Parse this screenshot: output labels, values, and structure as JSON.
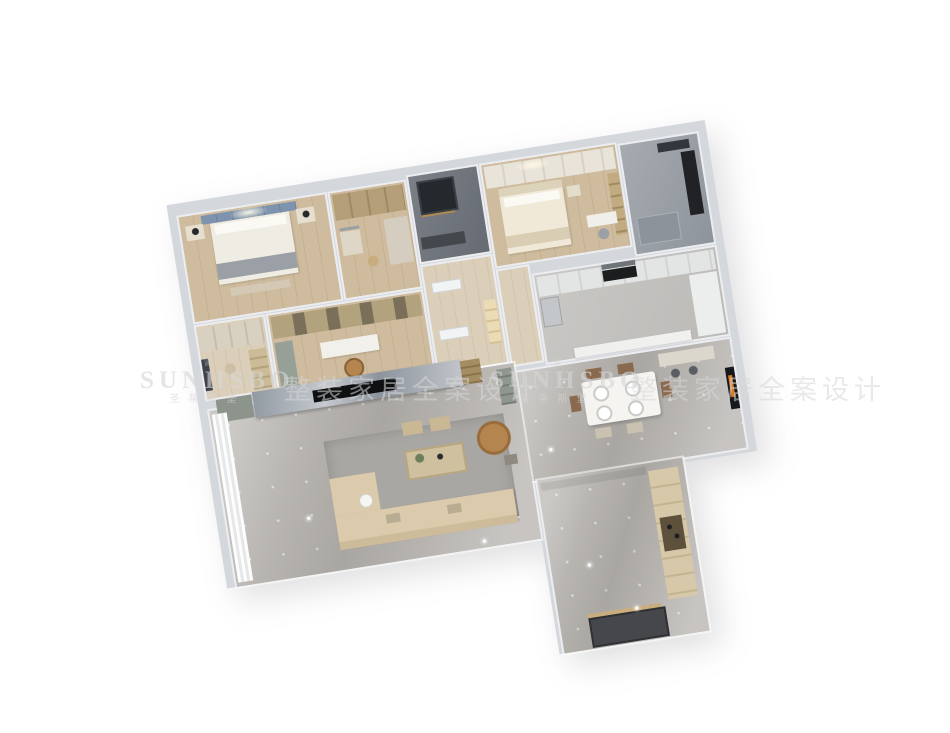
{
  "scene": {
    "type": "3d-apartment-floorplan-render",
    "background_color": "#ffffff",
    "rotation_deg": -9,
    "rooms": [
      {
        "id": "master-bedroom",
        "floor": "wood",
        "furniture": [
          "blue-panel-headboard",
          "double-bed",
          "gray-throw",
          "nightstand-left",
          "nightstand-right",
          "table-lamp",
          "table-lamp",
          "foot-bench"
        ]
      },
      {
        "id": "walk-in-closet",
        "floor": "wood",
        "furniture": [
          "glass-wardrobe",
          "side-cabinet",
          "vanity",
          "mirror",
          "stool"
        ]
      },
      {
        "id": "bathroom-dark",
        "floor": "dark-tile",
        "furniture": [
          "black-window-shower",
          "brass-fixture",
          "vanity"
        ]
      },
      {
        "id": "hallway",
        "floor": "light-wood",
        "furniture": [
          "door",
          "door",
          "lit-display-niche"
        ]
      },
      {
        "id": "second-bedroom",
        "floor": "wood",
        "furniture": [
          "wardrobe-run",
          "bed",
          "pillows",
          "nightstand",
          "bookshelf",
          "desk",
          "desk-chair"
        ]
      },
      {
        "id": "bathroom-gray",
        "floor": "gray-marble",
        "furniture": [
          "black-tall-cabinet",
          "mirror",
          "shower-tray"
        ]
      },
      {
        "id": "dressing-room",
        "floor": "light-wood",
        "furniture": [
          "wardrobe",
          "dark-window",
          "shelf-unit",
          "stool"
        ]
      },
      {
        "id": "study",
        "floor": "wood",
        "furniture": [
          "bookshelf-wall",
          "desk",
          "tan-leather-chair",
          "side-cabinet"
        ]
      },
      {
        "id": "kitchen",
        "floor": "gray-stone",
        "furniture": [
          "upper-counter-run",
          "range-hood",
          "black-cooktop",
          "fridge",
          "right-counter",
          "bar-counter"
        ]
      },
      {
        "id": "dining-room",
        "floor": "gray-marble",
        "furniture": [
          "dining-table",
          "place-setting",
          "place-setting",
          "place-setting",
          "place-setting",
          "brown-chairs",
          "cream-chairs",
          "sideboard",
          "bar-stools",
          "orange-wall-art"
        ]
      },
      {
        "id": "living-room",
        "floor": "gray-marble",
        "furniture": [
          "marble-tv-wall",
          "tv",
          "shelf-unit",
          "low-cabinet",
          "area-rug",
          "beige-sofa",
          "chaise",
          "coffee-table",
          "plant",
          "ottoman",
          "ottoman",
          "tan-armchair",
          "floor-lamp",
          "side-table",
          "sheer-curtains",
          "wine-cabinet"
        ]
      },
      {
        "id": "entry-corridor",
        "floor": "gray-marble",
        "furniture": [
          "shoe-cabinet",
          "display-niche",
          "shoes",
          "entry-door"
        ]
      }
    ]
  },
  "palette": {
    "wall_gray": "#d4d8dd",
    "wood_floor": "#cfbc9e",
    "gray_marble_floor": "#b7b4b0",
    "dark_tile": "#70757c",
    "headboard_blue": "#7e93ad",
    "sofa_beige": "#dbcaab",
    "tan_leather": "#b5854f",
    "tv_black": "#17181a",
    "art_orange": "#d97a1e"
  },
  "watermark": {
    "crown_icon": "♕",
    "brand_en": "SUNHSBO",
    "brand_cn": "圣蒂斯堡",
    "tagline_cn": "整装家居全案设计",
    "color": "#d5d5d5"
  }
}
